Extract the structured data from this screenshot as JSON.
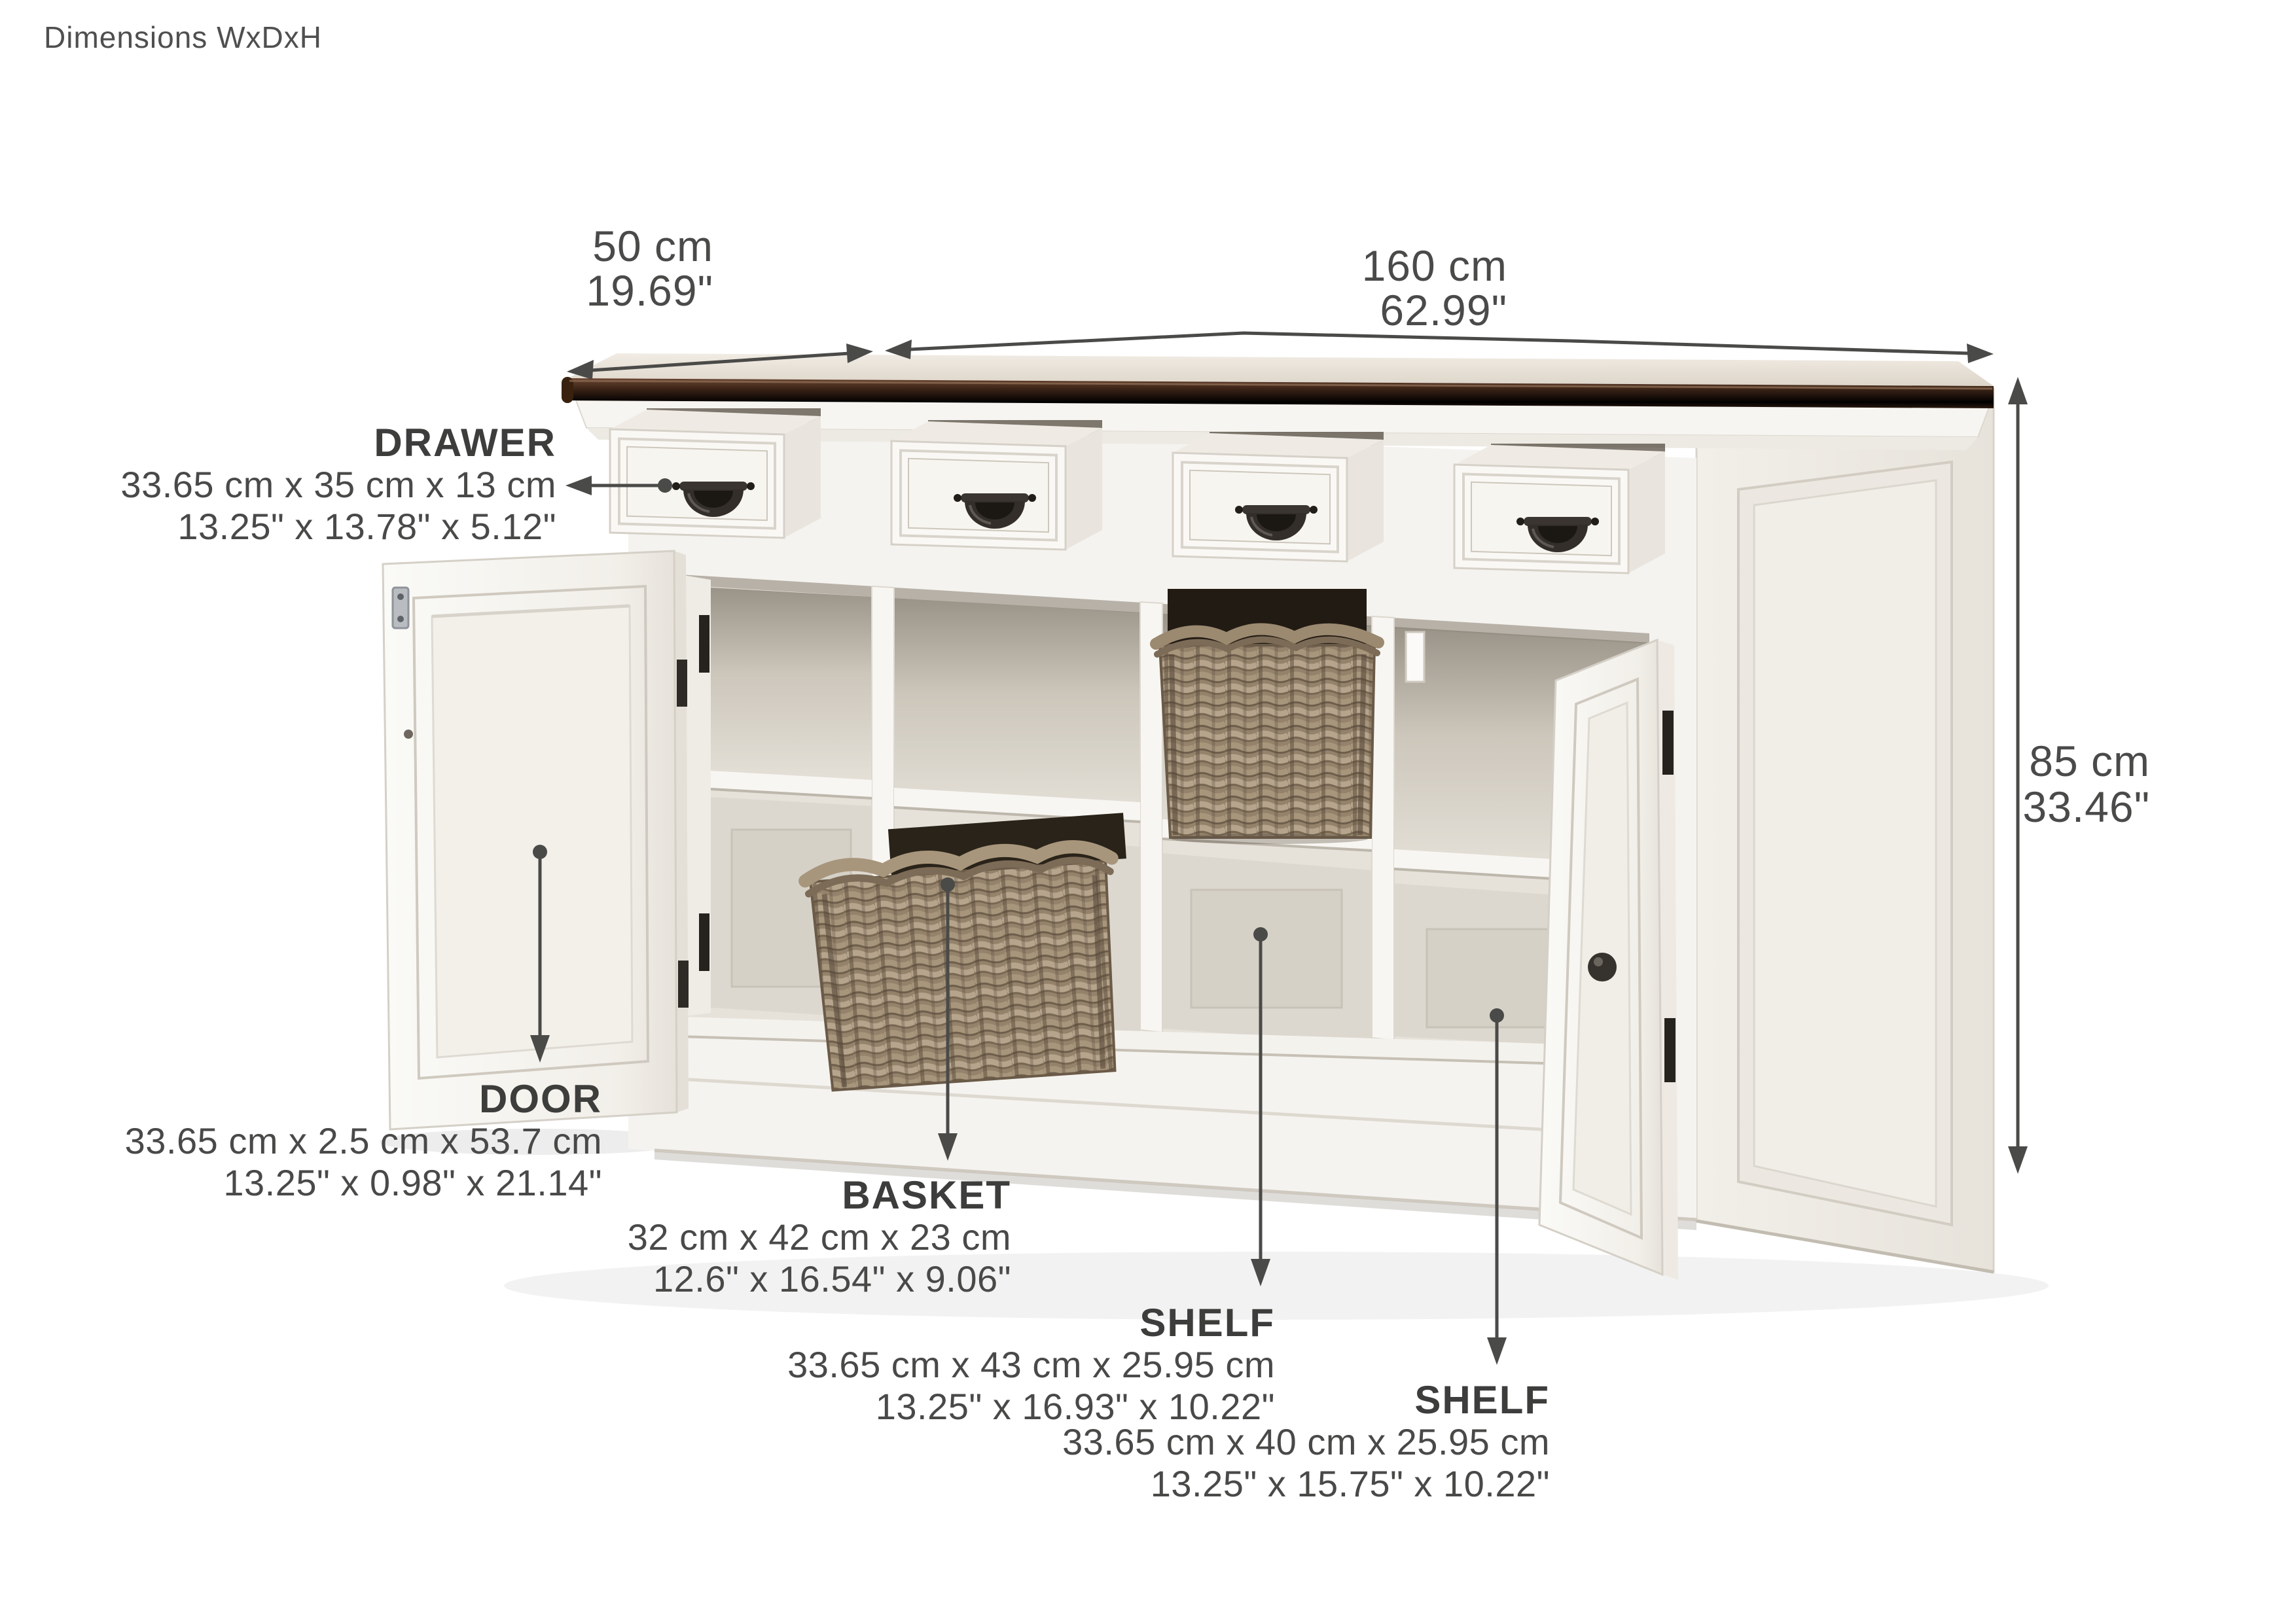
{
  "title": "Dimensions WxDxH",
  "overall_dimensions": {
    "depth": {
      "metric": "50 cm",
      "imperial": "19.69\""
    },
    "width": {
      "metric": "160 cm",
      "imperial": "62.99\""
    },
    "height": {
      "metric": "85 cm",
      "imperial": "33.46\""
    }
  },
  "callouts": [
    {
      "id": "drawer",
      "label": "DRAWER",
      "metric": "33.65 cm x 35 cm x 13 cm",
      "imperial": "13.25\" x 13.78\" x 5.12\""
    },
    {
      "id": "door",
      "label": "DOOR",
      "metric": "33.65 cm x 2.5 cm x 53.7 cm",
      "imperial": "13.25\" x 0.98\" x 21.14\""
    },
    {
      "id": "basket",
      "label": "BASKET",
      "metric": "32 cm x 42 cm x 23 cm",
      "imperial": "12.6\" x 16.54\" x 9.06\""
    },
    {
      "id": "shelf-middle",
      "label": "SHELF",
      "metric": "33.65 cm x 43 cm x 25.95 cm",
      "imperial": "13.25\" x 16.93\" x 10.22\""
    },
    {
      "id": "shelf-bottom",
      "label": "SHELF",
      "metric": "33.65 cm x 40 cm x 25.95 cm",
      "imperial": "13.25\" x 15.75\" x 10.22\""
    }
  ],
  "colors": {
    "background": "#ffffff",
    "text": "#494948",
    "label_text": "#3d3d3c",
    "leader_line": "#4a4a48",
    "wood_top": "#4a2e1f",
    "cabinet_white": "#f6f4f0",
    "basket_rattan": "#94826b",
    "handle_metal": "#332e29"
  }
}
